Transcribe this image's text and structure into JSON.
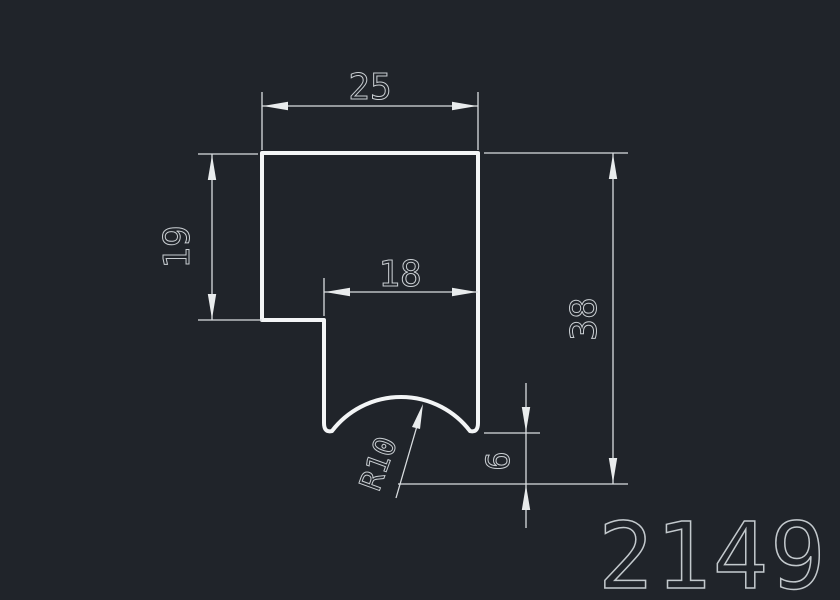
{
  "drawing": {
    "part_number": "2149",
    "dimensions": {
      "top_width": "25",
      "left_height": "19",
      "slot_width": "18",
      "overall_height": "38",
      "bottom_offset": "6",
      "radius": "R10"
    },
    "colors": {
      "background": "#20242a",
      "profile_line": "#f3f5f6",
      "dimension_line": "#d9dde0",
      "dimension_text": "#c9ced2",
      "part_number_text": "#c3c9cd"
    }
  }
}
